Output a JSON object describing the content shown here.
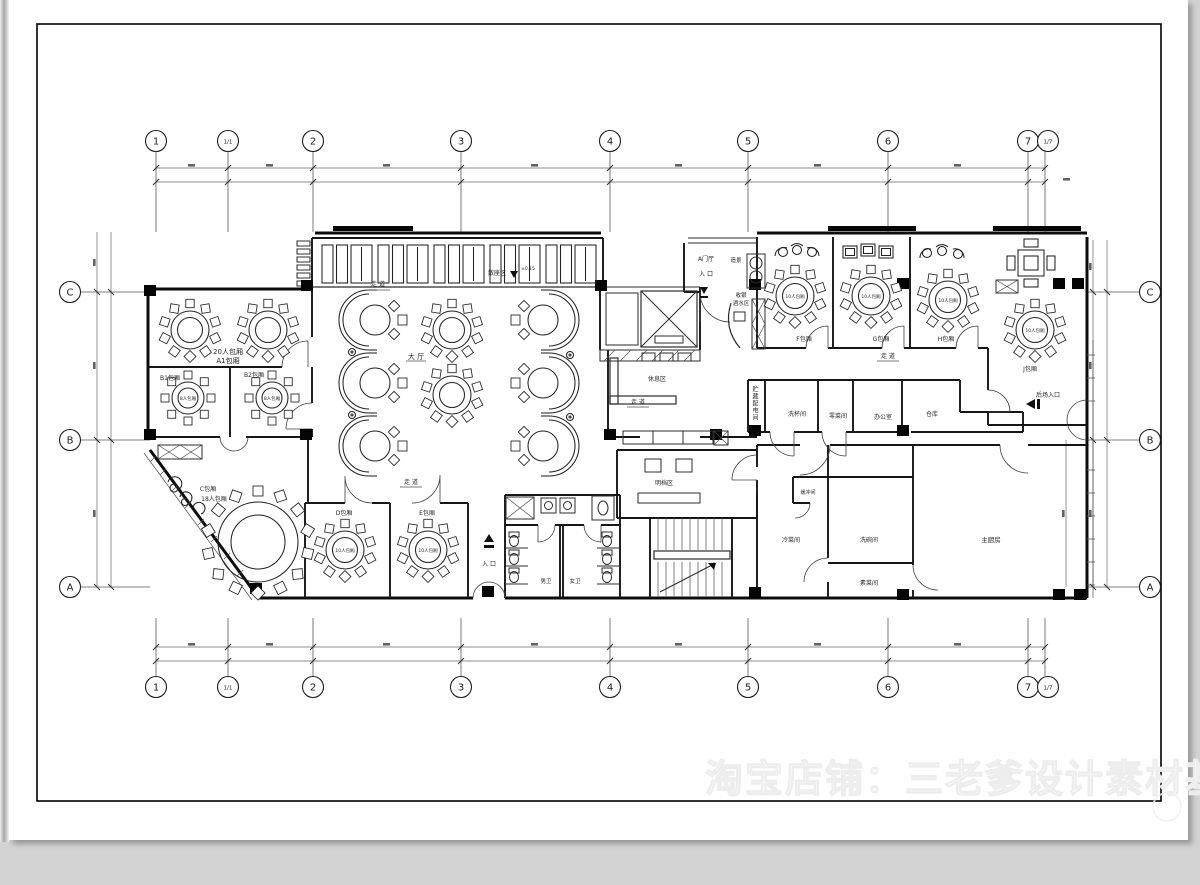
{
  "axes": {
    "horizontal": [
      "1",
      "1/1",
      "2",
      "3",
      "4",
      "5",
      "6",
      "7",
      "1/7"
    ],
    "vertical": [
      "C",
      "B",
      "A"
    ]
  },
  "labels": {
    "seating_area": "散座区",
    "level": "±0.15",
    "corridor": "走 道",
    "hall": "大 厅",
    "lounge": "休息区",
    "open_kitchen": "明档区",
    "male_wc": "男卫",
    "female_wc": "女卫",
    "entrance": "入 口",
    "foyer": "A门厅",
    "scenery": "造景",
    "cashier": "收银",
    "drinks": "酒水区",
    "rear_entrance": "后场入口",
    "storage_power": "贮藏配电间",
    "cup_wash": "洗杯间",
    "veg_room": "零菜间",
    "office": "办公室",
    "warehouse": "仓库",
    "buffer": "缓冲间",
    "cold_dish": "冷菜间",
    "dish_wash": "洗碗间",
    "veg_dish": "素菜间",
    "main_kitchen": "主厨房",
    "room_20": "20人包厢",
    "room_a1": "A1包厢",
    "room_b1": "B1包厢",
    "room_b2": "B2包厢",
    "room_c": "C包厢",
    "room_c18": "18人包厢",
    "room_d": "D包厢",
    "room_e": "E包厢",
    "room_f": "F包厢",
    "room_g": "G包厢",
    "room_h": "H包厢",
    "room_j": "J包厢",
    "table_10": "10人包厢",
    "table_8": "8人包厢"
  },
  "watermark": {
    "text": "淘宝店铺：三老爹设计素材基地"
  }
}
